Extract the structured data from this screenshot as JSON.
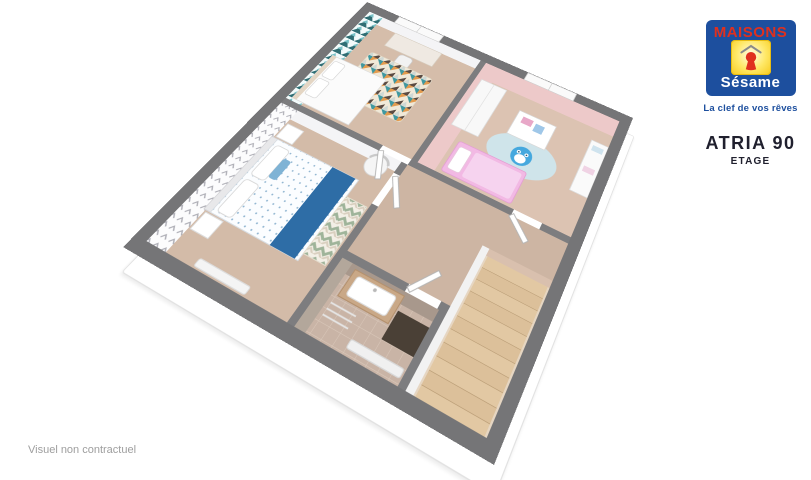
{
  "branding": {
    "logo_top": "MAISONS",
    "logo_script": "Sésame",
    "tagline": "La clef de vos rêves"
  },
  "plan": {
    "title": "ATRIA 90",
    "level_label": "ETAGE"
  },
  "footer": {
    "disclaimer": "Visuel non contractuel"
  },
  "colors": {
    "logo_blue": "#1d4f9e",
    "logo_red": "#e0301e",
    "logo_yellow": "#f8c81c",
    "wall_gray": "#757577",
    "floor_wood": "#d6beac",
    "kids_room_pink": "#edc9c9",
    "kids_bed_pink": "#f2b9e4",
    "office_teal": "#3f98a0",
    "master_runner_blue": "#2e6da6",
    "stair_wood": "#e0c6a2"
  }
}
